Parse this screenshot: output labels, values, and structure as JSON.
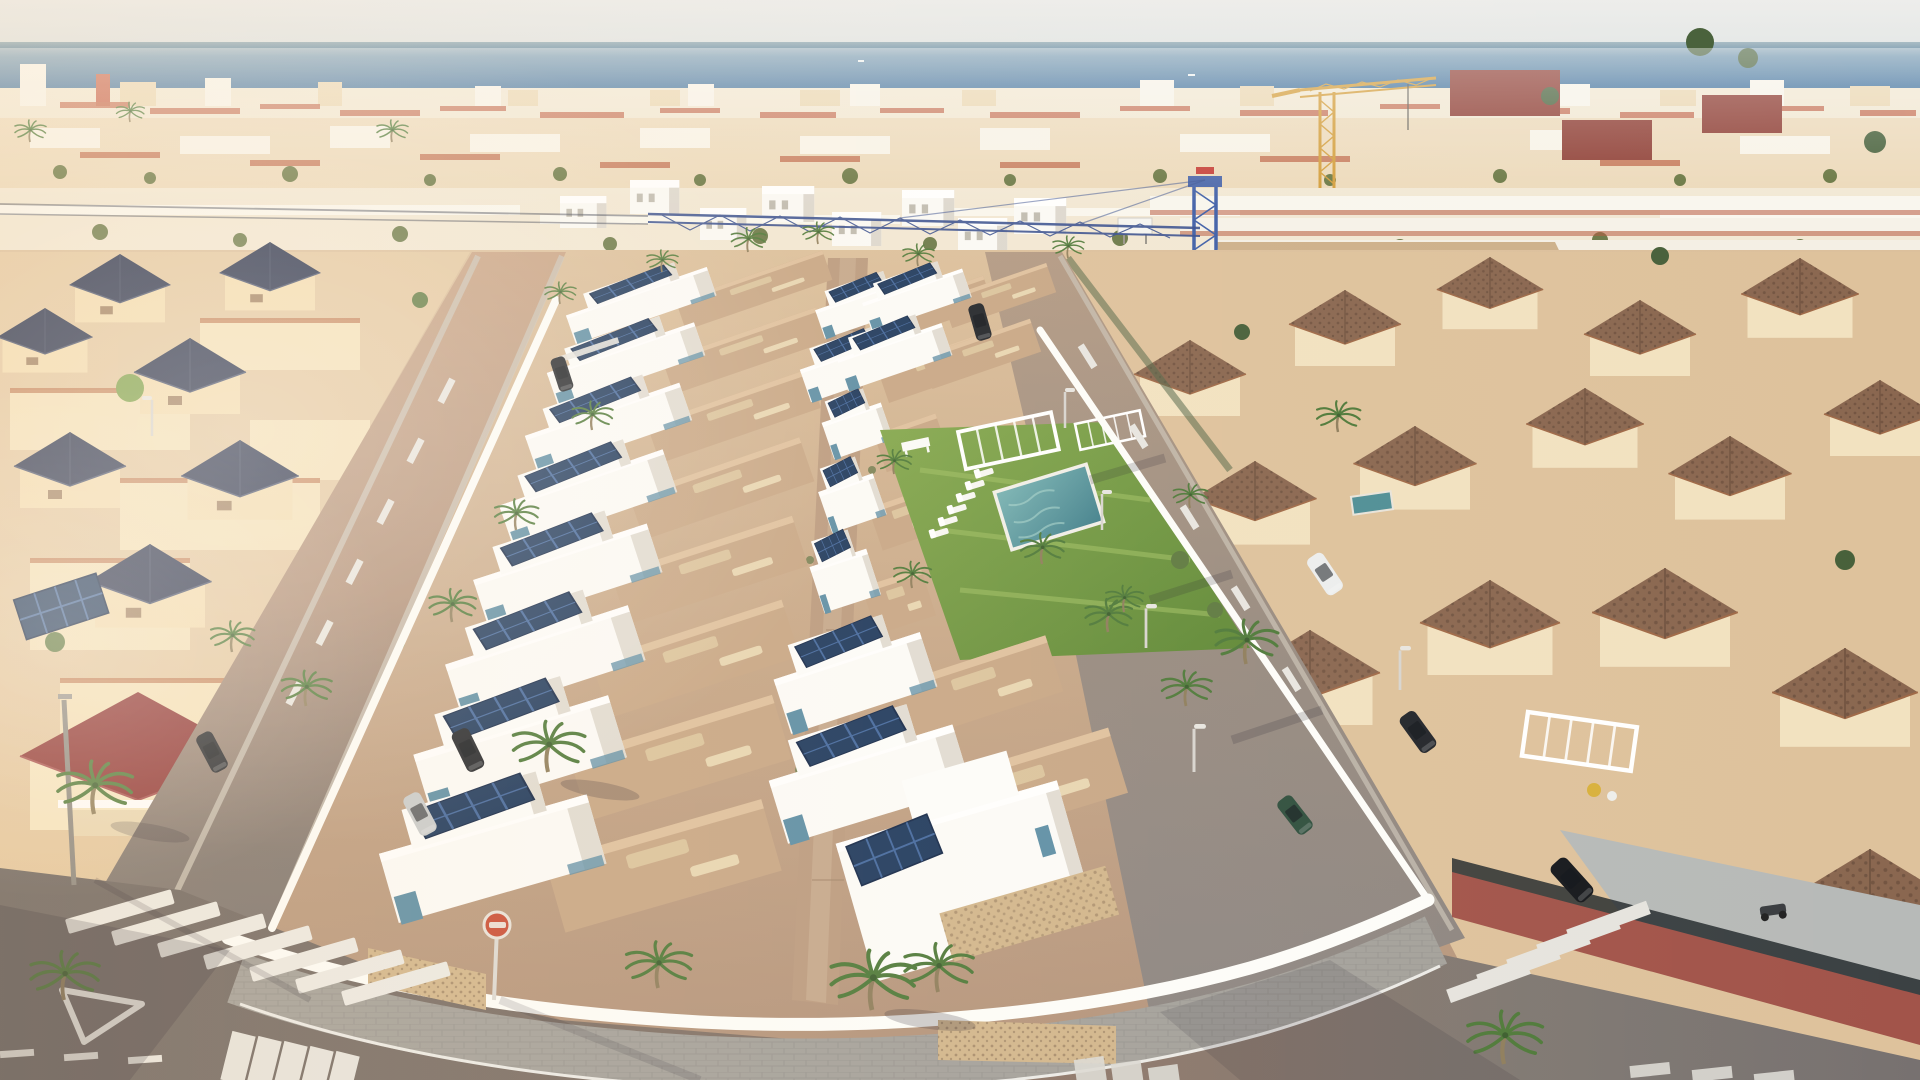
{
  "meta": {
    "type": "aerial-photograph",
    "description": "Oblique aerial drone view of a coastal town: a new-build development of white flat-roofed townhouses with rooftop terraces, solar panels and a communal lawn with pool, flanked by an older cream villa neighbourhood with navy pyramid roofs on the left and brown-tile-roof villas on the right. Streets with zebra crossings, parked cars and palm trees in the foreground; dense beachfront town, two tower cranes and the sea on the horizon under a hazy sky.",
    "lighting": "low warm sun from the left, long shadows to the right"
  },
  "palette": {
    "sky": "#e9ebe9",
    "sea": "#45759f",
    "white": "#fcfbf8",
    "whiteshade": "#e1dcd3",
    "cream": "#f3ddb1",
    "navyroof": "#28324e",
    "redroof": "#8f3434",
    "brownroof": "#8a6750",
    "maroonroof": "#8c3a30",
    "terracotta": "#c07a52",
    "terrace": "#c8a786",
    "terrace2": "#dfc19e",
    "teal": "#5e8fa6",
    "solar": "#1f3a5e",
    "solarline": "#44699f",
    "lawn": "#6d9440",
    "pool": "#4f8e96",
    "palm": "#4f7a3a",
    "stone": "#d2b68c",
    "craneblue": "#3f5fa8",
    "craneyellow": "#d29b36",
    "roadwarm": "#c9a486",
    "roadgray": "#7b7472",
    "sidewalk": "#a4a19b",
    "brick": "#a2544a",
    "cardark": "#23262b",
    "carsilver": "#c9cccd",
    "carwhite": "#eceeee",
    "cargreen": "#2f4f3e",
    "ground": "#c6a687"
  },
  "scene": {
    "sky": {
      "label": "hazy pale sky"
    },
    "sea": {
      "label": "sea on horizon",
      "boats": 3
    },
    "distant_town": {
      "label": "dense beachfront town with cream walls and terracotta roofs"
    },
    "cranes": [
      {
        "label": "blue lattice tower crane",
        "position": "center"
      },
      {
        "label": "yellow tower crane",
        "position": "upper right"
      }
    ],
    "new_development": {
      "label": "new white townhouse development",
      "rows": 2,
      "features": [
        "rooftop terraces",
        "solar panels",
        "teal glass accents",
        "stone-clad walls",
        "white perimeter wall",
        "central walkway"
      ]
    },
    "communal_garden": {
      "label": "communal garden",
      "lawn": true,
      "pool": true,
      "sun_loungers": 6,
      "pergolas": 2,
      "bench": 1
    },
    "left_neighbourhood": {
      "label": "cream villas with navy pyramid roofs",
      "red_roof_villa": 1
    },
    "right_neighbourhood": {
      "label": "villas with mottled brown tile roofs",
      "brick_fences": true,
      "white_pergola": 1,
      "yellow_parasol": 1,
      "private_pool": 1
    },
    "roads": {
      "zebra_crossings": 4,
      "give_way_triangle": 1,
      "red_circular_sign": 1,
      "lane_dashes": true,
      "street_lamps": 7
    },
    "vehicles": {
      "parked_dark": 5,
      "parked_silver": 1,
      "moving_white": 1,
      "green": 1,
      "black_sedan": 1
    },
    "vegetation": {
      "palm_trees": 28,
      "shrubs": "scattered"
    }
  }
}
